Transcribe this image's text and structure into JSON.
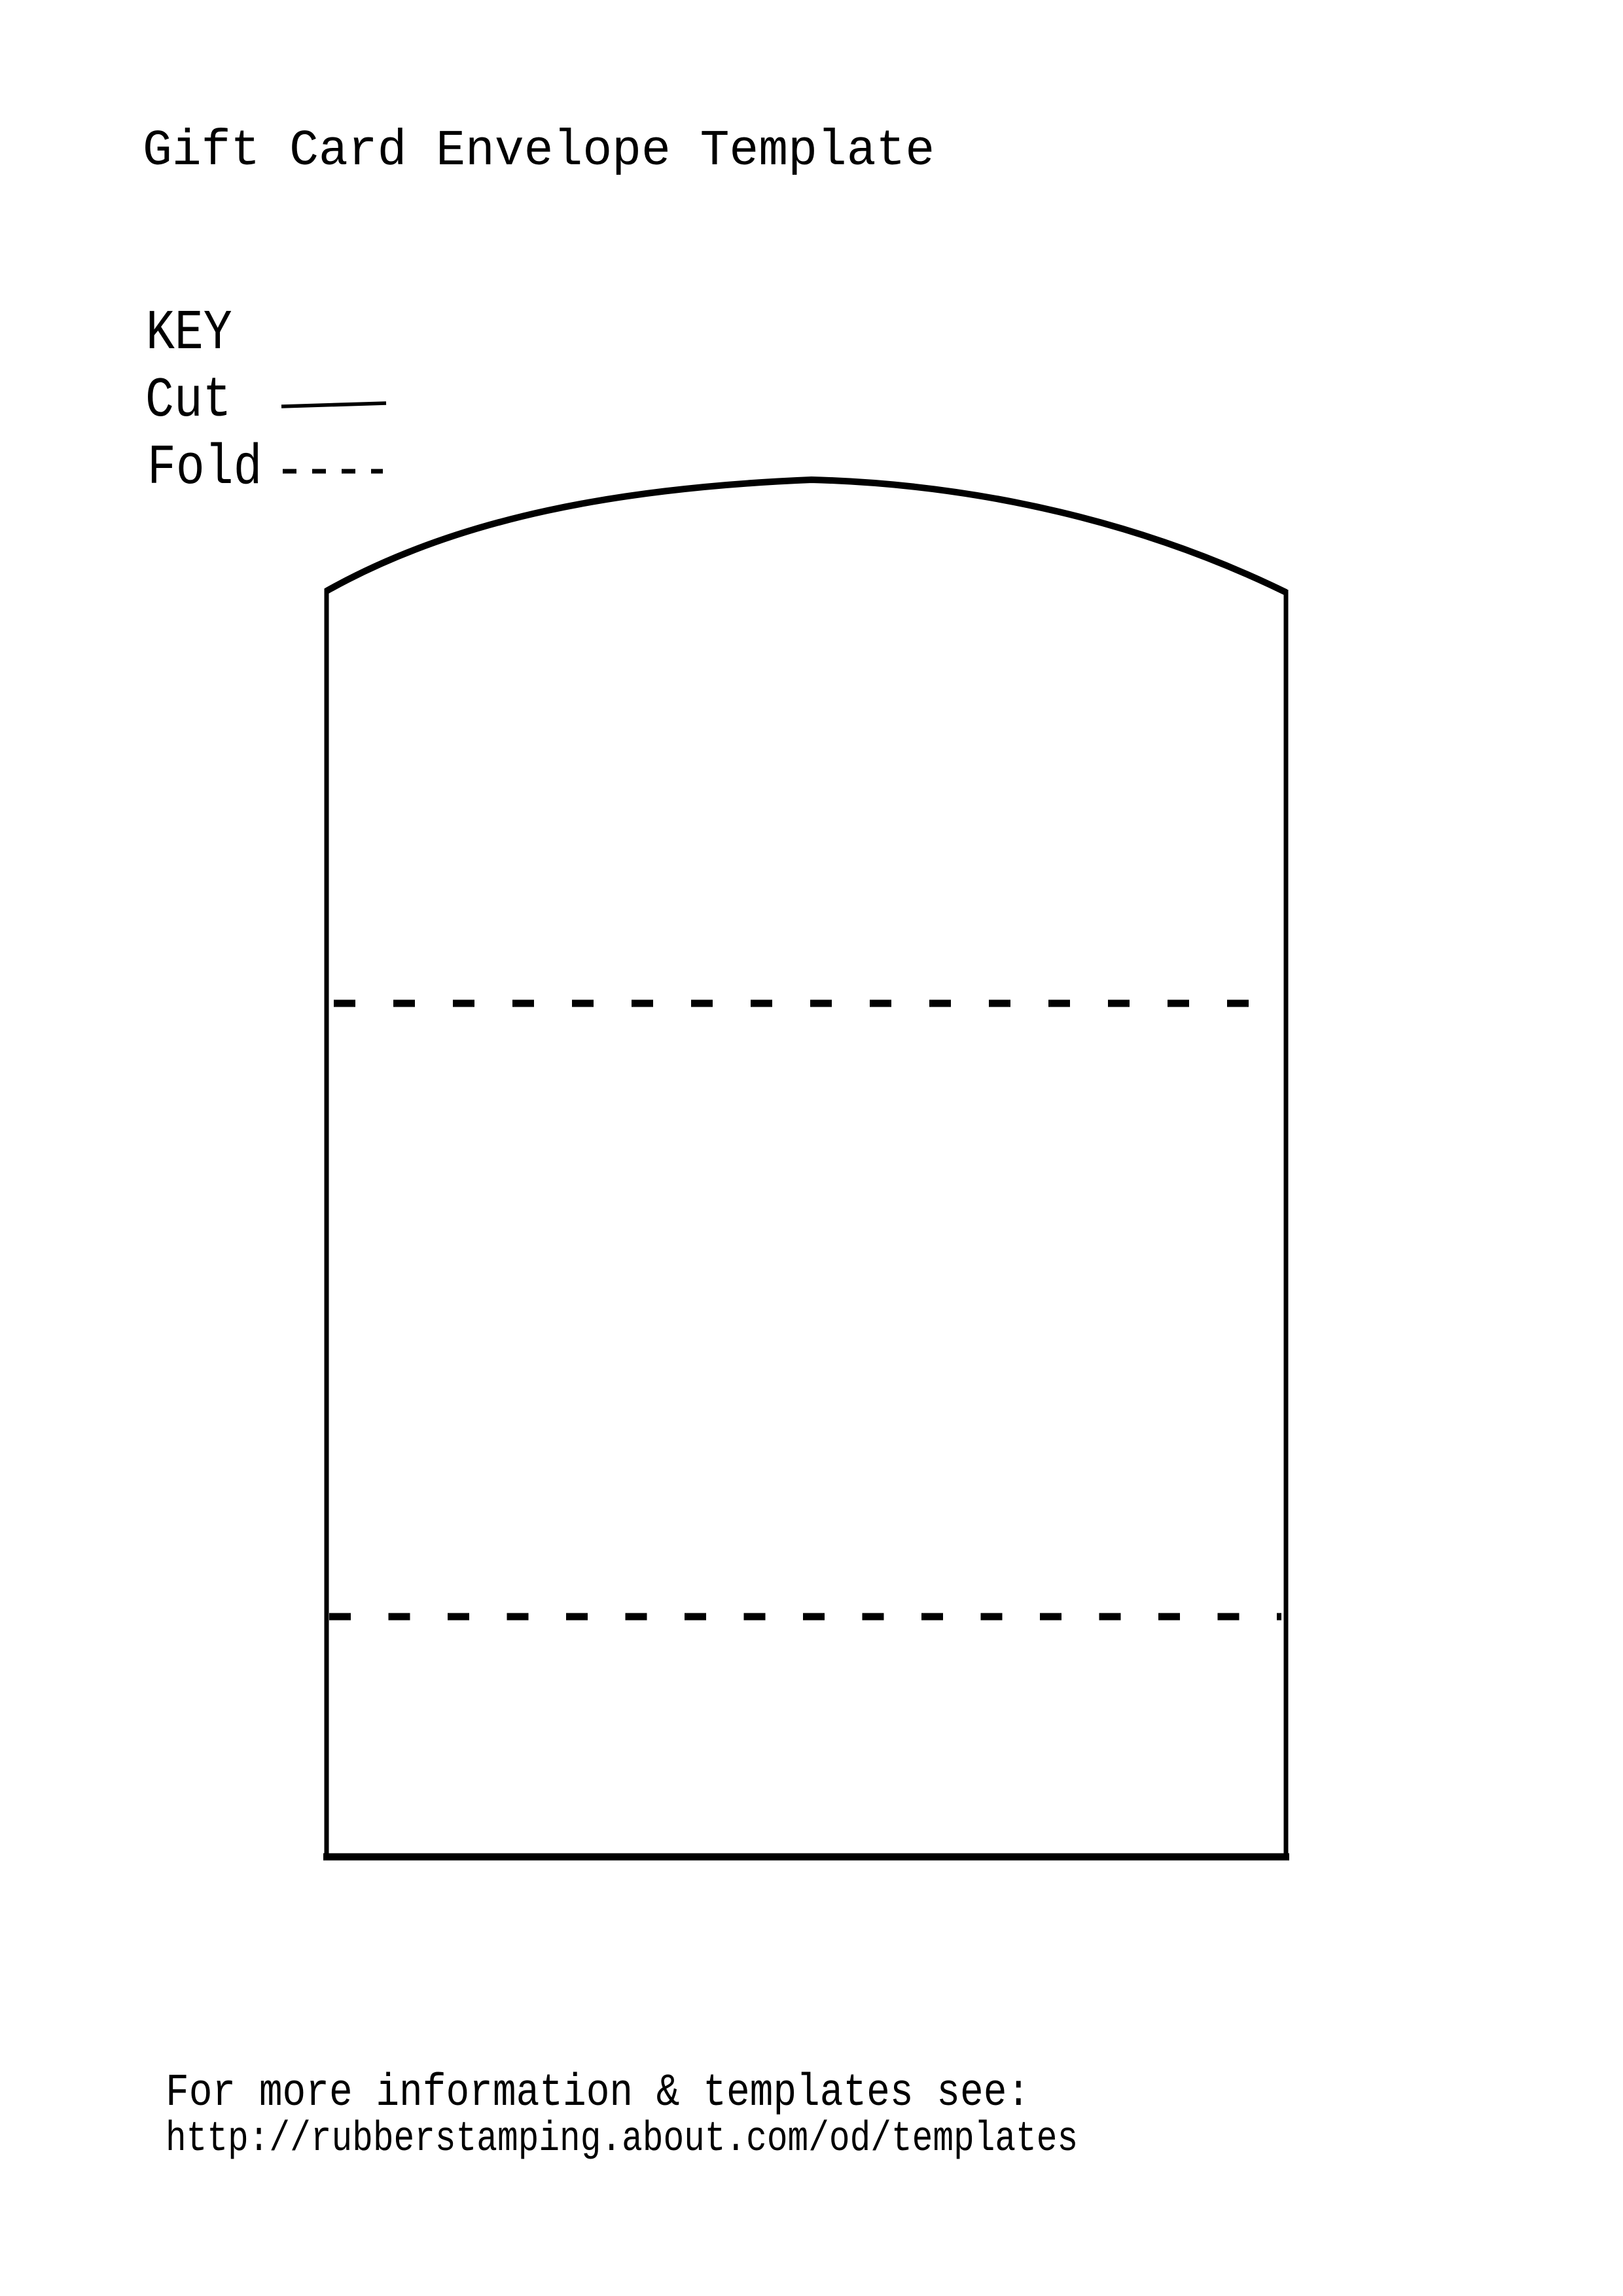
{
  "page": {
    "background": "#ffffff",
    "ink": "#000000"
  },
  "title": "Gift Card Envelope Template",
  "key": {
    "heading": "KEY",
    "cut_label": "Cut",
    "fold_label": "Fold"
  },
  "footer": {
    "info_line": "For more information & templates see:",
    "url_line": "http://rubberstamping.about.com/od/templates"
  }
}
